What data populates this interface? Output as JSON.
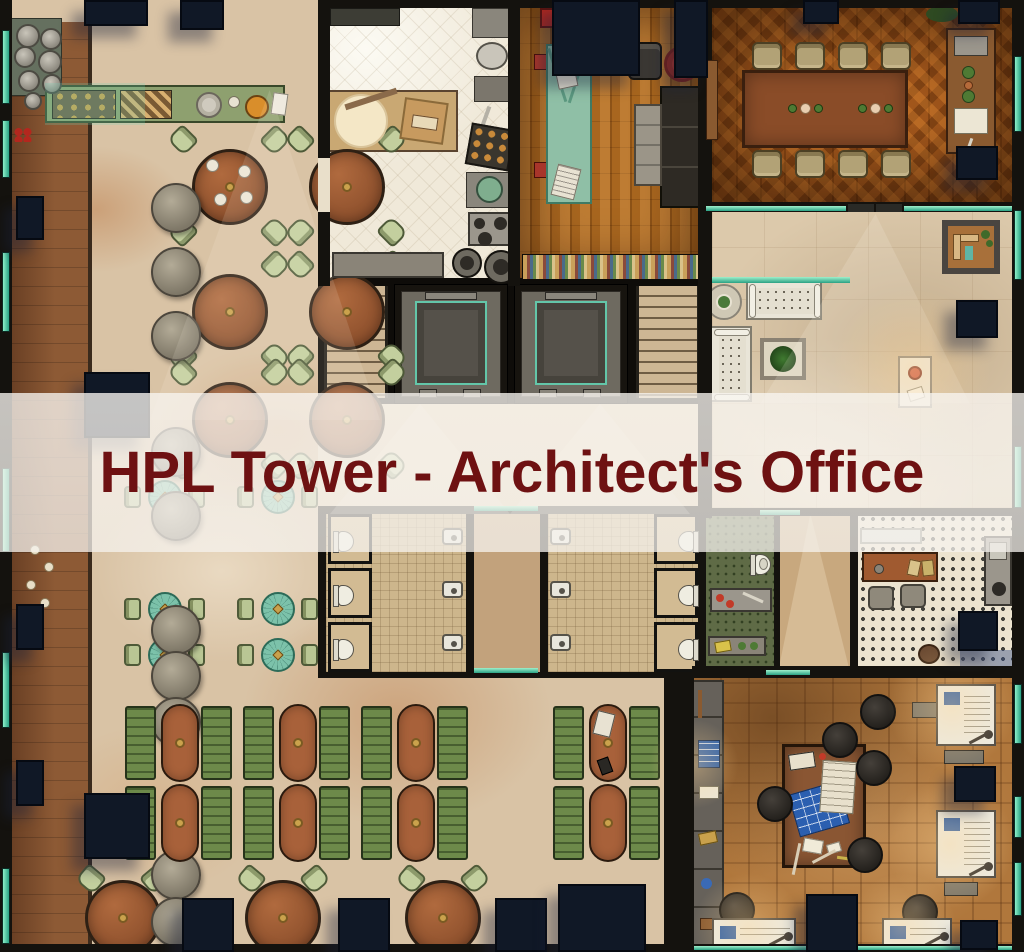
{
  "banner": {
    "title": "HPL Tower - Architect's Office",
    "text_color": "#6e1112",
    "bg": "rgba(246,243,238,0.75)"
  },
  "palette": {
    "glass_teal": "#2aa184",
    "glass_bright": "#8cf0c8",
    "pillar_navy": "#101826",
    "wall_dark": "#14120e",
    "marble": "#d9c3a5",
    "marble_vein": "#b97a4e",
    "booth_green": "#6d8a4a",
    "table_brown": "#a05c36",
    "chair_green": "#c3cf9e",
    "teal_table": "#7cc2aa",
    "blueprint_blue": "#2d5fb0",
    "sofa_red": "#b3271e",
    "kitchen_tile": "#f0e9d9",
    "herringbone": "#a4581c",
    "parquet": "#b0773c"
  },
  "map": {
    "pillars": [
      [
        84,
        0,
        64,
        26
      ],
      [
        180,
        0,
        44,
        30
      ],
      [
        552,
        0,
        88,
        76
      ],
      [
        674,
        0,
        34,
        78
      ],
      [
        803,
        0,
        36,
        24
      ],
      [
        958,
        0,
        42,
        24
      ],
      [
        84,
        372,
        66,
        66
      ],
      [
        84,
        793,
        66,
        66
      ],
      [
        16,
        196,
        28,
        44
      ],
      [
        16,
        604,
        28,
        46
      ],
      [
        16,
        760,
        28,
        46
      ],
      [
        956,
        146,
        42,
        34
      ],
      [
        956,
        300,
        42,
        38
      ],
      [
        958,
        611,
        40,
        40
      ],
      [
        954,
        766,
        42,
        36
      ],
      [
        960,
        920,
        38,
        30
      ],
      [
        182,
        898,
        52,
        54
      ],
      [
        338,
        898,
        52,
        54
      ],
      [
        495,
        898,
        52,
        54
      ],
      [
        558,
        884,
        88,
        68
      ],
      [
        806,
        894,
        52,
        58
      ]
    ],
    "walls": [
      [
        318,
        0,
        706,
        8
      ],
      [
        318,
        0,
        12,
        286
      ],
      [
        508,
        0,
        12,
        286
      ],
      [
        698,
        0,
        14,
        518
      ],
      [
        706,
        202,
        318,
        10
      ],
      [
        664,
        672,
        30,
        280
      ],
      [
        692,
        666,
        332,
        12
      ],
      [
        706,
        508,
        318,
        8
      ],
      [
        774,
        514,
        6,
        158
      ],
      [
        850,
        514,
        8,
        158
      ],
      [
        692,
        944,
        332,
        8
      ],
      [
        0,
        0,
        12,
        952
      ],
      [
        1012,
        0,
        12,
        952
      ],
      [
        12,
        944,
        652,
        8
      ],
      [
        466,
        514,
        8,
        158
      ],
      [
        540,
        514,
        8,
        158
      ]
    ],
    "teal_segments": [
      [
        712,
        277,
        138,
        6
      ],
      [
        706,
        206,
        140,
        5
      ],
      [
        904,
        206,
        108,
        5
      ],
      [
        474,
        506,
        64,
        5
      ],
      [
        474,
        668,
        64,
        5
      ],
      [
        766,
        670,
        44,
        5
      ],
      [
        760,
        510,
        40,
        5
      ],
      [
        694,
        946,
        318,
        4
      ]
    ],
    "windows_left": [
      [
        30,
        74
      ],
      [
        120,
        58
      ],
      [
        252,
        80
      ],
      [
        468,
        84
      ],
      [
        652,
        76
      ],
      [
        868,
        76
      ]
    ],
    "windows_right": [
      [
        56,
        76
      ],
      [
        210,
        70
      ],
      [
        446,
        62
      ],
      [
        684,
        60
      ],
      [
        796,
        42
      ],
      [
        862,
        54
      ]
    ],
    "dining_tables": [
      [
        230,
        187
      ],
      [
        347,
        187
      ],
      [
        230,
        312
      ],
      [
        347,
        312
      ],
      [
        230,
        420
      ],
      [
        347,
        420
      ]
    ],
    "teal_tables": [
      [
        165,
        497
      ],
      [
        278,
        497
      ],
      [
        165,
        609
      ],
      [
        278,
        609
      ],
      [
        165,
        655
      ],
      [
        278,
        655
      ]
    ],
    "stools": [
      [
        176,
        208
      ],
      [
        176,
        272
      ],
      [
        176,
        336
      ],
      [
        176,
        452
      ],
      [
        176,
        516
      ],
      [
        176,
        630
      ],
      [
        176,
        676
      ],
      [
        176,
        722
      ],
      [
        176,
        875
      ],
      [
        176,
        922
      ]
    ],
    "plates": [
      [
        16,
        24,
        24
      ],
      [
        40,
        28,
        22
      ],
      [
        14,
        46,
        22
      ],
      [
        38,
        50,
        24
      ],
      [
        18,
        70,
        22
      ],
      [
        42,
        74,
        20
      ],
      [
        24,
        92,
        18
      ]
    ],
    "walk_dishes": [
      [
        30,
        545
      ],
      [
        44,
        562
      ],
      [
        26,
        580
      ],
      [
        40,
        598
      ],
      [
        32,
        615
      ]
    ],
    "booths": {
      "rows": [
        706,
        786
      ],
      "benches": [
        125,
        201,
        243,
        319,
        361,
        437,
        553,
        629
      ],
      "tables": [
        161,
        279,
        397,
        589
      ]
    },
    "bottom_tables": [
      [
        123,
        918
      ],
      [
        283,
        918
      ],
      [
        443,
        918
      ]
    ],
    "conference_chairs": [
      [
        752,
        42
      ],
      [
        795,
        42
      ],
      [
        838,
        42
      ],
      [
        881,
        42
      ],
      [
        752,
        150
      ],
      [
        795,
        150
      ],
      [
        838,
        150
      ],
      [
        881,
        150
      ]
    ],
    "conf_items": [
      [
        788,
        104
      ],
      [
        858,
        104
      ]
    ],
    "stall_ys": [
      514,
      568,
      622
    ],
    "sink_ys": [
      528,
      581,
      634
    ],
    "office_stools": [
      [
        840,
        740
      ],
      [
        874,
        768
      ],
      [
        775,
        804
      ],
      [
        865,
        855
      ],
      [
        737,
        910
      ],
      [
        920,
        912
      ],
      [
        878,
        712
      ]
    ],
    "drafting_tables": [
      [
        936,
        684,
        60,
        62
      ],
      [
        936,
        810,
        60,
        68
      ],
      [
        712,
        918,
        84,
        30
      ],
      [
        882,
        918,
        70,
        30
      ]
    ],
    "dt_bases": [
      [
        944,
        750,
        40,
        14
      ],
      [
        944,
        882,
        34,
        14
      ],
      [
        912,
        702,
        26,
        16
      ]
    ],
    "book_rings": [
      [
        540,
        262
      ],
      [
        588,
        262
      ],
      [
        634,
        262
      ],
      [
        678,
        262
      ]
    ],
    "lights": [
      {
        "x": 150,
        "y": 90,
        "w": 230,
        "h": 330,
        "poly": "52% 0,0 100%,100% 100%",
        "c": "rgba(255,246,230,0.13)"
      },
      {
        "x": 760,
        "y": 214,
        "w": 210,
        "h": 190,
        "poly": "55% 0,0 100%,100% 100%",
        "c": "rgba(255,248,238,0.16)"
      },
      {
        "x": 778,
        "y": 514,
        "w": 72,
        "h": 158,
        "poly": "45% 0,0 100%,100% 100%",
        "c": "rgba(255,242,218,0.26)"
      },
      {
        "x": 330,
        "y": 404,
        "w": 180,
        "h": 110,
        "poly": "50% 0,0 100%,100% 100%",
        "c": "rgba(255,250,240,0.20)"
      },
      {
        "x": 510,
        "y": 404,
        "w": 180,
        "h": 110,
        "poly": "50% 0,0 100%,100% 100%",
        "c": "rgba(255,250,240,0.20)"
      }
    ],
    "glows": [
      [
        952,
        706,
        130
      ],
      [
        950,
        844,
        130
      ],
      [
        748,
        928,
        110
      ],
      [
        902,
        928,
        110
      ],
      [
        694,
        764,
        90
      ],
      [
        912,
        368,
        160
      ]
    ]
  }
}
